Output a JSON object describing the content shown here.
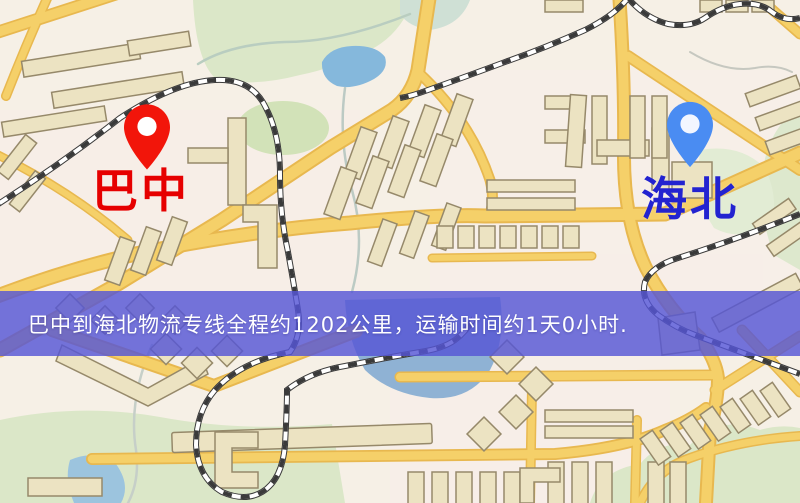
{
  "page": {
    "type": "logistics-route-map"
  },
  "markers": {
    "origin": {
      "name": "巴中",
      "pin_color": "#f2150a",
      "label_color": "#e60000",
      "icon": "map-pin"
    },
    "destination": {
      "name": "海北",
      "pin_color": "#4a8cf2",
      "label_color": "#2323d0",
      "icon": "map-pin"
    }
  },
  "banner": {
    "text": "巴中到海北物流专线全程约1202公里，运输时间约1天0小时.",
    "distance_km": "1202",
    "transit_time": "1天0小时",
    "background_color": "#5656d6",
    "text_color": "#ffffff"
  },
  "map_colors": {
    "background": "#f6f0e6",
    "road_fill": "#f5d069",
    "road_casing": "#e8b84f",
    "building_fill": "#ece3c2",
    "building_outline": "#96896a",
    "park_green": "#dbe7c8",
    "water_blue": "#8fc0e0",
    "railway_dark": "#3a3a3a"
  }
}
